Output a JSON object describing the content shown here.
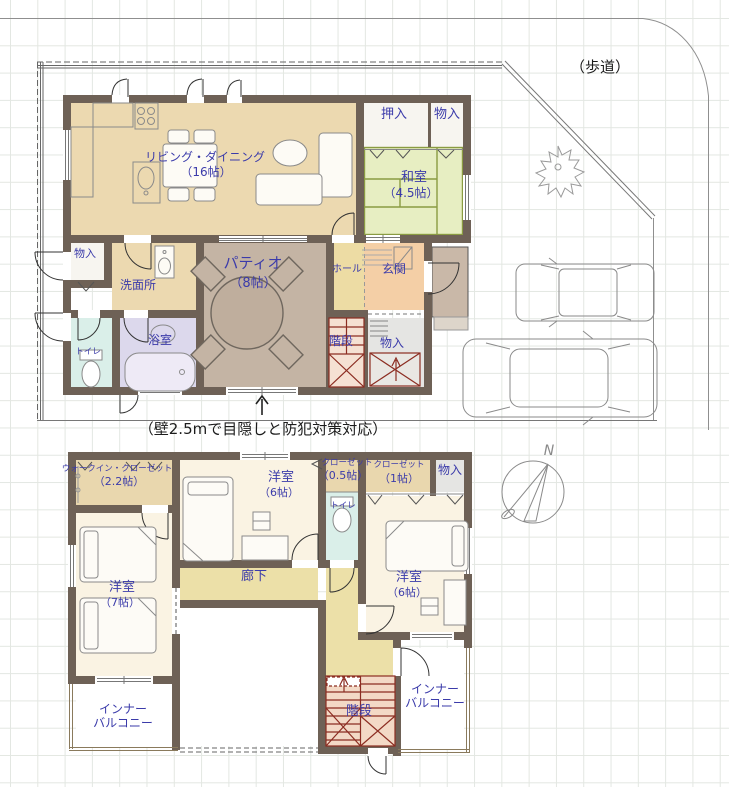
{
  "site": {
    "sidewalk": "（歩道）",
    "wall_note": "（壁2.5mで目隠しと防犯対策対応）",
    "north": "N"
  },
  "floor1": {
    "living": {
      "name": "リビング・ダイニング",
      "size": "（16帖）"
    },
    "oshiire": {
      "name": "押入"
    },
    "storage_top": {
      "name": "物入"
    },
    "washitsu": {
      "name": "和室",
      "size": "（4.5帖）"
    },
    "storage_left": {
      "name": "物入"
    },
    "washroom": {
      "name": "洗面所"
    },
    "toilet": {
      "name": "トイレ"
    },
    "bathroom": {
      "name": "浴室"
    },
    "patio": {
      "name": "パティオ",
      "size": "（8帖）"
    },
    "hall": {
      "name": "ホール"
    },
    "entrance": {
      "name": "玄関"
    },
    "stairs": {
      "name": "階段"
    },
    "storage_stairs": {
      "name": "物入"
    }
  },
  "floor2": {
    "walk_in_closet": {
      "name": "ウォークイン・クローゼット",
      "size": "（2.2帖）"
    },
    "bedroom_north": {
      "name": "洋室",
      "size": "（6帖）"
    },
    "closet_small": {
      "name": "クローゼット",
      "size": "（0.5帖）"
    },
    "closet": {
      "name": "クローゼット",
      "size": "（1帖）"
    },
    "storage": {
      "name": "物入"
    },
    "toilet": {
      "name": "トイレ"
    },
    "bedroom_east": {
      "name": "洋室",
      "size": "（6帖）"
    },
    "bedroom_west": {
      "name": "洋室",
      "size": "（7帖）"
    },
    "corridor": {
      "name": "廊下"
    },
    "stairs": {
      "name": "階段"
    },
    "balcony_left": {
      "line1": "インナー",
      "line2": "バルコニー"
    },
    "balcony_right": {
      "line1": "インナー",
      "line2": "バルコニー"
    }
  },
  "colors": {
    "wall": "#6e6156",
    "label_blue": "#3b3baa",
    "living_tan": "#ecd9b0",
    "tatami_green": "#e7eec2",
    "tatami_edge": "#8a9b42",
    "patio_taupe": "#c4b4a4",
    "hall_yellow": "#eddca4",
    "entrance_peach": "#f4cfa6",
    "toilet_cyan": "#daefe9",
    "bath_lavender": "#dcd8ec",
    "storage_grey": "#e5e5e3",
    "corridor_yellow": "#ece0a8",
    "bedroom_cream": "#faf3e3",
    "stair_fill": "#f3d9c6",
    "stair_line": "#8c2d22"
  }
}
